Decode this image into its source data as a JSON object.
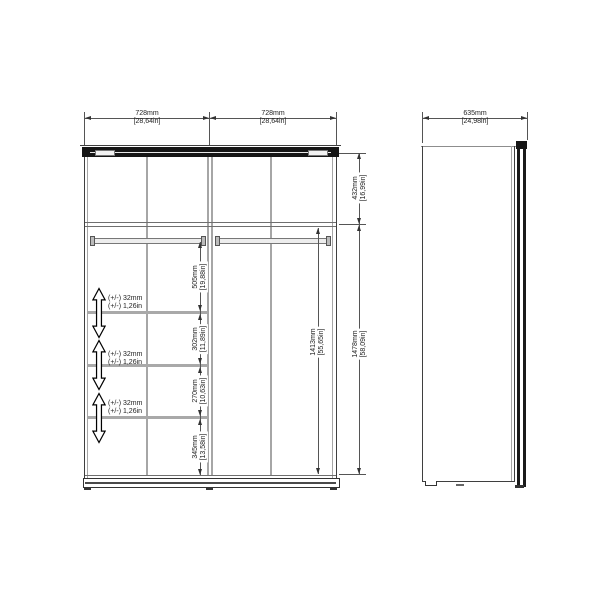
{
  "drawing": {
    "front_view": {
      "top_dims": [
        {
          "mm": "728mm",
          "in": "[28,64in]"
        },
        {
          "mm": "728mm",
          "in": "[28,64in]"
        }
      ],
      "right_dims": [
        {
          "mm": "432mm",
          "in": "[16,99in]"
        },
        {
          "mm": "1478mm",
          "in": "[58,09in]"
        }
      ],
      "inner_dim": {
        "mm": "1413mm",
        "in": "[55,65in]"
      },
      "chain_dims": [
        {
          "mm": "505mm",
          "in": "[19,88in]"
        },
        {
          "mm": "302mm",
          "in": "[11,89in]"
        },
        {
          "mm": "270mm",
          "in": "[10,63in]"
        },
        {
          "mm": "345mm",
          "in": "[13,58in]"
        }
      ],
      "tolerances": [
        {
          "line1": "(+/-) 32mm",
          "line2": "(+/-) 1,26in"
        },
        {
          "line1": "(+/-) 32mm",
          "line2": "(+/-) 1,26in"
        },
        {
          "line1": "(+/-) 32mm",
          "line2": "(+/-) 1,26in"
        }
      ]
    },
    "side_view": {
      "top_dim": {
        "mm": "635mm",
        "in": "[24,98in]"
      }
    },
    "colors": {
      "line": "#3f3f3f",
      "panel_gray": "#a6a6a6",
      "track_dark": "#161616",
      "background": "#ffffff"
    }
  }
}
